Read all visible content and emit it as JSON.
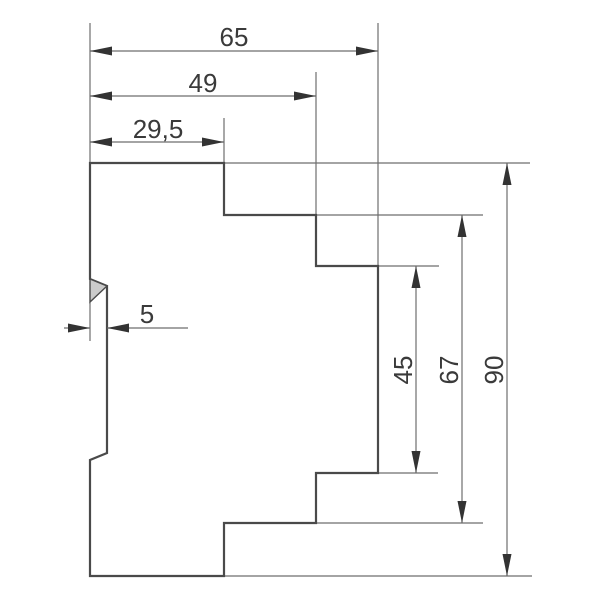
{
  "drawing": {
    "description": "Technical side-profile drawing of a DIN-rail mounted device with dimension lines",
    "units_shown": false,
    "canvas": {
      "width": 600,
      "height": 600
    },
    "colors": {
      "background": "#ffffff",
      "profile_line": "#4a4a4a",
      "thin_line": "#6e6e6e",
      "arrow": "#333333",
      "text": "#3a3a3a",
      "wedge_fill": "#cbcbcb"
    },
    "profile": {
      "name": "device-outline",
      "outline_points": [
        [
          90,
          163
        ],
        [
          224,
          163
        ],
        [
          224,
          215
        ],
        [
          316,
          215
        ],
        [
          316,
          266
        ],
        [
          378,
          266
        ],
        [
          378,
          473
        ],
        [
          316,
          473
        ],
        [
          316,
          523
        ],
        [
          224,
          523
        ],
        [
          224,
          576
        ],
        [
          90,
          576
        ],
        [
          90,
          460
        ],
        [
          107,
          453
        ],
        [
          107,
          286
        ],
        [
          90,
          279
        ]
      ],
      "wedge_points": [
        [
          90,
          279
        ],
        [
          107,
          286
        ],
        [
          90,
          302
        ]
      ]
    },
    "extension_lines": [
      {
        "name": "ext-left-vertical",
        "x1": 90,
        "y1": 23,
        "x2": 90,
        "y2": 163
      },
      {
        "name": "ext-65-right",
        "x1": 378,
        "y1": 23,
        "x2": 378,
        "y2": 266
      },
      {
        "name": "ext-49-right",
        "x1": 316,
        "y1": 72,
        "x2": 316,
        "y2": 215
      },
      {
        "name": "ext-29-5-right",
        "x1": 224,
        "y1": 118,
        "x2": 224,
        "y2": 163
      },
      {
        "name": "ext-5-below-wedge",
        "x1": 90,
        "y1": 302,
        "x2": 90,
        "y2": 341
      },
      {
        "name": "ext-top-face-to-90",
        "x1": 224,
        "y1": 163,
        "x2": 530,
        "y2": 163
      },
      {
        "name": "ext-mid-step-to-67",
        "x1": 316,
        "y1": 215,
        "x2": 483,
        "y2": 215
      },
      {
        "name": "ext-front-top-to-45",
        "x1": 378,
        "y1": 266,
        "x2": 439,
        "y2": 266
      },
      {
        "name": "ext-front-bottom-to-45",
        "x1": 378,
        "y1": 473,
        "x2": 438,
        "y2": 473
      },
      {
        "name": "ext-mid-bottom-to-67",
        "x1": 316,
        "y1": 523,
        "x2": 483,
        "y2": 523
      },
      {
        "name": "ext-bottom-face-to-90",
        "x1": 224,
        "y1": 576,
        "x2": 532,
        "y2": 576
      }
    ],
    "dimensions": [
      {
        "name": "dim-65",
        "label": "65",
        "orientation": "h",
        "style": "inside",
        "line_pos": 51,
        "from": 90,
        "to": 378,
        "label_x": 234,
        "label_y": 46
      },
      {
        "name": "dim-49",
        "label": "49",
        "orientation": "h",
        "style": "inside",
        "line_pos": 96,
        "from": 90,
        "to": 316,
        "label_x": 203,
        "label_y": 92
      },
      {
        "name": "dim-29-5",
        "label": "29,5",
        "orientation": "h",
        "style": "inside",
        "line_pos": 142,
        "from": 90,
        "to": 224,
        "label_x": 158,
        "label_y": 138
      },
      {
        "name": "dim-5",
        "label": "5",
        "orientation": "h",
        "style": "outside",
        "line_pos": 328,
        "from": 90,
        "to": 107,
        "tail_from": 64,
        "leader_to": 188,
        "label_x": 147,
        "label_y": 323
      },
      {
        "name": "dim-45",
        "label": "45",
        "orientation": "v",
        "style": "inside",
        "line_pos": 416,
        "from": 266,
        "to": 473,
        "label_x": 412,
        "label_y": 370
      },
      {
        "name": "dim-67",
        "label": "67",
        "orientation": "v",
        "style": "inside",
        "line_pos": 462,
        "from": 215,
        "to": 523,
        "label_x": 458,
        "label_y": 370
      },
      {
        "name": "dim-90",
        "label": "90",
        "orientation": "v",
        "style": "inside",
        "line_pos": 507,
        "from": 163,
        "to": 576,
        "label_x": 503,
        "label_y": 370
      }
    ],
    "arrow": {
      "length": 22,
      "half_width": 4.5
    }
  }
}
